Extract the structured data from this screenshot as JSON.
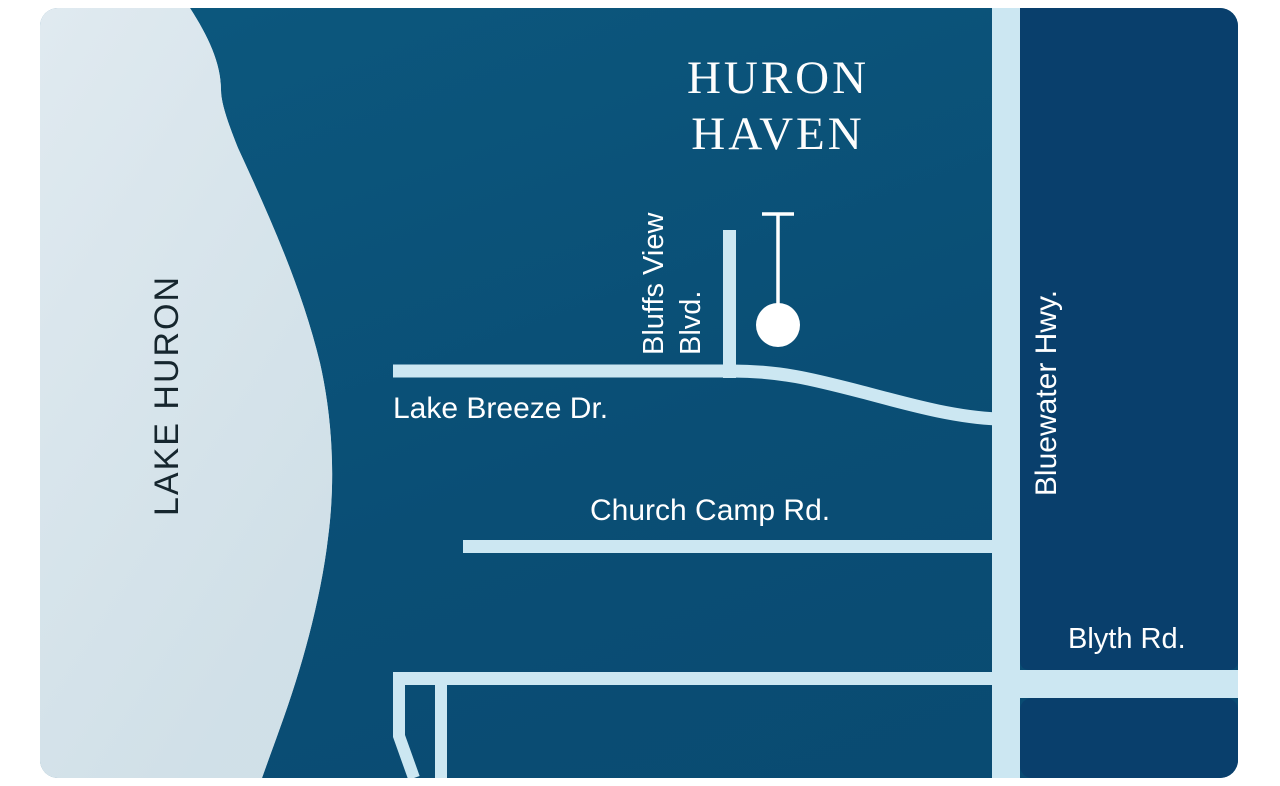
{
  "map": {
    "title_line1": "HURON",
    "title_line2": "HAVEN",
    "labels": {
      "lake": "LAKE HURON",
      "bluffs_line1": "Bluffs View",
      "bluffs_line2": "Blvd.",
      "lake_breeze": "Lake Breeze Dr.",
      "church_camp": "Church Camp Rd.",
      "bluewater": "Bluewater Hwy.",
      "blyth": "Blyth Rd."
    },
    "icons": {
      "marker": "location-pin"
    },
    "colors": {
      "land_teal_top": "#0c587e",
      "land_teal_bottom": "#094a71",
      "east_land_navy": "#093f6c",
      "lake_light": "#d7e4eb",
      "road_light": "#cce7f2",
      "marker_white": "#ffffff",
      "lake_text": "#16262e",
      "label_text": "#ffffff",
      "page_background": "#ffffff"
    }
  }
}
